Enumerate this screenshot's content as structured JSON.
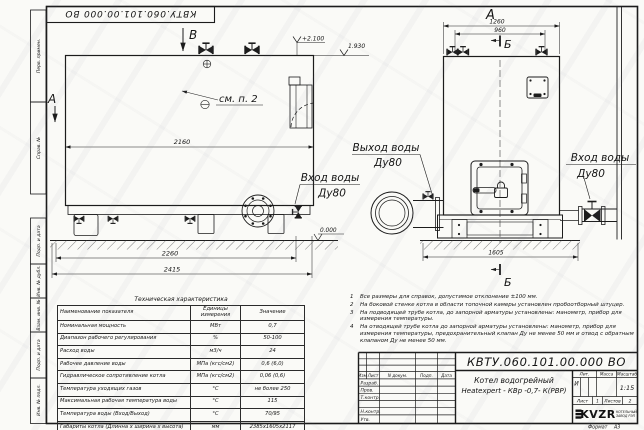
{
  "sheet": {
    "doc_number_top": "КВТУ.060.101.00.000 ВО",
    "format_label": "Формат",
    "format_value": "А3",
    "margin_labels": {
      "perv_primen": "Перв. примен.",
      "sprav_no": "Справ. №",
      "podp_data_1": "Подп. и дата",
      "inv_dubl": "Инв. № дубл.",
      "vzam_inv": "Взам. инв. №",
      "podp_data_2": "Подп. и дата",
      "inv_podl": "Инв. № подл."
    }
  },
  "drawing": {
    "view_labels": {
      "v_top": "В",
      "a_left": "А",
      "a_front": "А",
      "b_top": "Б",
      "b_bottom": "Б"
    },
    "callout_note": "см. п. 2",
    "elevations": {
      "fittings": "+2.100",
      "roof": "1.930",
      "ground": "0.000"
    },
    "dimensions": {
      "body_length": "2160",
      "base_length": "2260",
      "overall_length": "2415",
      "front_width": "1260",
      "front_inner_width": "960",
      "front_base_width": "1605"
    },
    "labels": {
      "outlet_title": "Выход воды",
      "outlet_dn": "Ду80",
      "inlet_left_title": "Вход воды",
      "inlet_left_dn": "Ду80",
      "inlet_right_title": "Вход воды",
      "inlet_right_dn": "Ду80"
    }
  },
  "notes": {
    "items": [
      {
        "num": "1",
        "text": "Все размеры для справок, допустимое отклонение ±100 мм."
      },
      {
        "num": "2",
        "text": "На боковой стенке котла в области топочной камеры установлен пробоотборный штуцер."
      },
      {
        "num": "3",
        "text": "На подводящей трубе котла, до запорной арматуры установлены: манометр, прибор для измерения температуры."
      },
      {
        "num": "4",
        "text": "На отводящей трубе котла до запорной арматуры установлены: манометр, прибор для измерения температуры, предохранительный клапан Ду не менее 50 мм и отвод с обратным клапаном Ду не менее 50 мм."
      }
    ]
  },
  "tech_table": {
    "title": "Техническая характеристика",
    "headers": [
      "Наименование показателя",
      "Единицы измерения",
      "Значение"
    ],
    "rows": [
      [
        "Номинальная мощность",
        "МВт",
        "0,7"
      ],
      [
        "Диапазон рабочего регулирования",
        "%",
        "50-100"
      ],
      [
        "Расход воды",
        "м3/ч",
        "24"
      ],
      [
        "Рабочее давление воды",
        "МПа (кгс/см2)",
        "0,6 (6,0)"
      ],
      [
        "Гидравлическое сопротивление котла",
        "МПа (кгс/см2)",
        "0,06 (0,6)"
      ],
      [
        "Температура уходящих газов",
        "°С",
        "не более 250"
      ],
      [
        "Максимальная рабочая температура воды",
        "°С",
        "115"
      ],
      [
        "Температура воды (Вход/Выход)",
        "°С",
        "70/95"
      ],
      [
        "Габариты котла (Длинна х ширина х высота)",
        "мм",
        "2385х1605х2117"
      ]
    ]
  },
  "title_block": {
    "doc_number": "КВТУ.060.101.00.000 ВО",
    "product_line1": "Котел водогрейный",
    "product_line2": "Heatexpert - КВр -0,7- К(РВР)",
    "col_headers": {
      "izm": "Изм",
      "list": "Лист",
      "ndoc": "N докум.",
      "podp": "Подп.",
      "data": "Дата"
    },
    "sig_rows": {
      "razrab": "Разраб.",
      "prov": "Пров.",
      "tkontr": "Т.контр.",
      "nkontr": "Н.контр.",
      "utv": "Утв."
    },
    "lit_header": "Лит.",
    "mass_header": "Масса",
    "scale_header": "Масштаб",
    "lit_value": "И",
    "scale_value": "1:15",
    "sheet_label": "Лист",
    "sheet_value": "1",
    "sheets_label": "Листов",
    "sheets_value": "2",
    "logo_text": "KVZR",
    "logo_sub_line1": "КОТЕЛЬНЫЙ",
    "logo_sub_line2": "ЗАВОД РЭП"
  },
  "colors": {
    "line": "#1c1c1c",
    "paper": "#fafaf7"
  }
}
